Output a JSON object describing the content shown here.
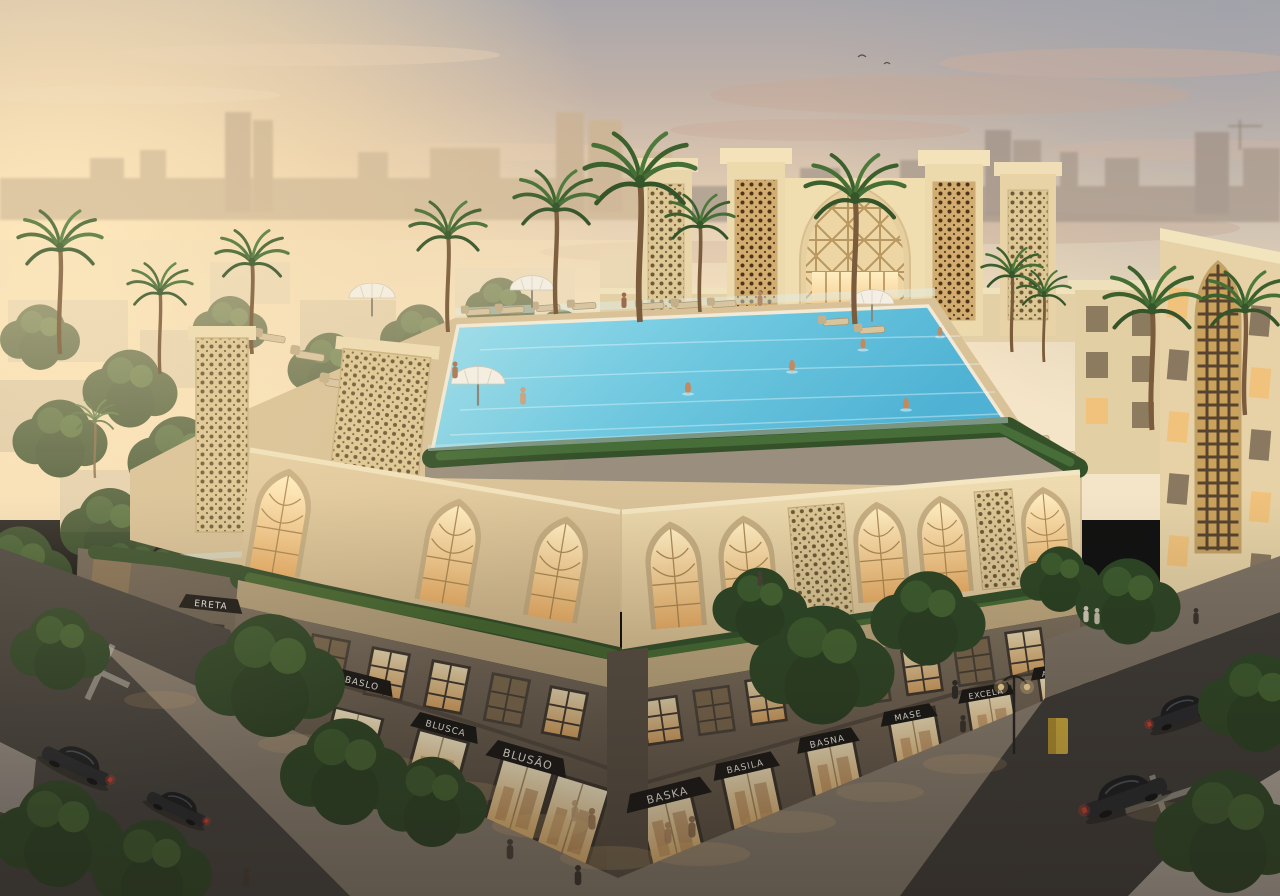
{
  "scene": {
    "type": "architectural-rendering",
    "time_of_day": "sunset",
    "subject": "Mixed-use building with rooftop infinity pool, arabesque lattice facades, lit retail storefronts, dusk streets with cars and trees"
  },
  "signs": {
    "storefront_labels": [
      "BASRA",
      "ERETA",
      "BASLO",
      "BLUSCA",
      "BLUSÃO",
      "BASKA",
      "BASILA",
      "BASNA",
      "MASE",
      "EXCELA",
      "ANNIA"
    ]
  },
  "colors": {
    "sky_warm": "#f6dfb8",
    "sky_cool": "#a9a6aa",
    "cloud_pink": "#c9a795",
    "stone_light": "#ecd9ae",
    "stone_shadow": "#cbb488",
    "lattice_gold": "#dcc795",
    "retail_stone": "#6e6254",
    "awning_black": "#171513",
    "window_glow": "#f3c57f",
    "pool_aqua": "#63c3dc",
    "foliage_street": "#2e4725",
    "asphalt": "#43403b",
    "sidewalk": "#8d8172",
    "taillight_red": "#d8402f",
    "kiosk_yellow": "#d6b13e"
  }
}
